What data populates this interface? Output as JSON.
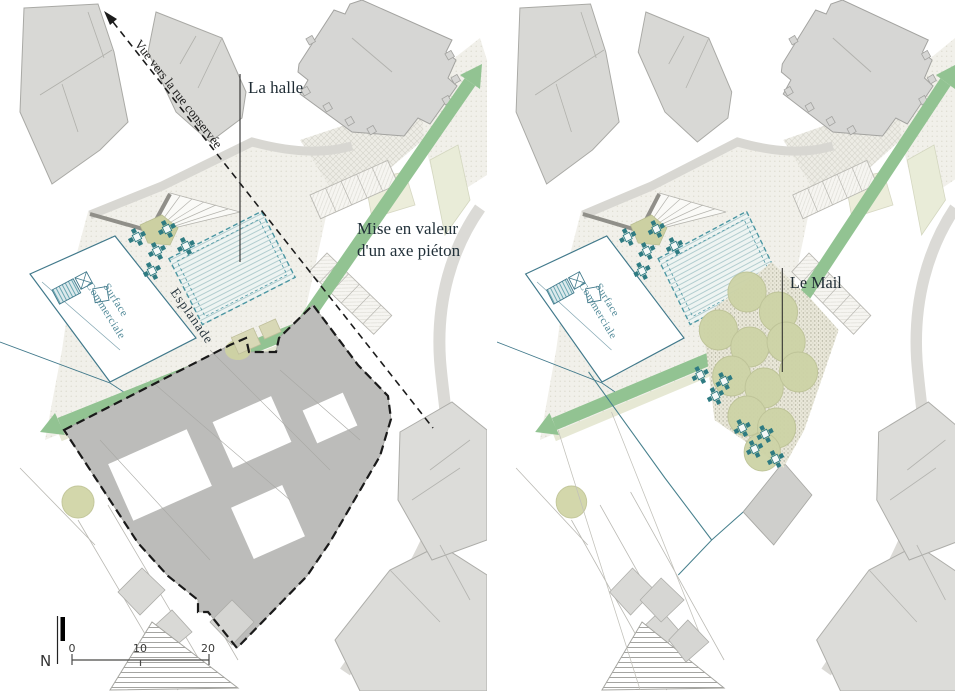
{
  "figure": {
    "description_left": "site plan with demolition outline",
    "description_right": "site plan project with mail of trees"
  },
  "labels": {
    "view_axis": "Vue vers la rue conservée",
    "halle": "La halle",
    "axis_note_line1": "Mise en valeur",
    "axis_note_line2": "d'un axe piéton",
    "esplanade": "Esplanade",
    "surface_line1": "Surface",
    "surface_line2": "Commerciale",
    "mail": "Le Mail",
    "north": "N",
    "scale_ticks": [
      "0",
      "10",
      "20"
    ]
  },
  "colors": {
    "building_fill": "#d8d8d5",
    "building_stroke": "#a8a8a4",
    "demolition_fill": "#bcbcba",
    "axis_green": "#92c392",
    "teal_outline": "#41798b",
    "halle_dash": "#4b96a2",
    "tree_fill": "#cdd3a6",
    "label_text": "#22313a",
    "demolition_dash": "#1a1a1a"
  }
}
